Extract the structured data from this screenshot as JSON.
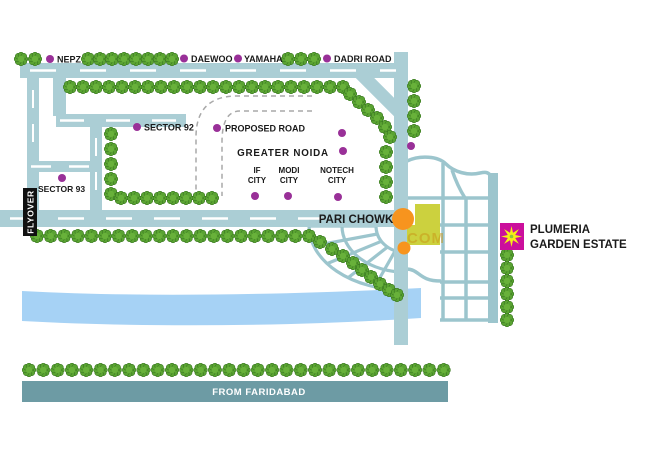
{
  "map": {
    "region_label": "GREATER NOIDA",
    "landmarks": {
      "nepz": "NEPZ",
      "daewoo": "DAEWOO",
      "yamaha": "YAMAHA",
      "dadri_road": "DADRI ROAD",
      "sector_92": "SECTOR 92",
      "proposed_road": "PROPOSED ROAD",
      "if_city": [
        "IF",
        "CITY"
      ],
      "modi_city": [
        "MODI",
        "CITY"
      ],
      "notech_city": [
        "NOTECH",
        "CITY"
      ],
      "sector_93": "SECTOR 93"
    },
    "road_labels": {
      "flyover": "FLYOVER",
      "pari_chowk": "PARI CHOWK",
      "from_faridabad": "FROM FARIDABAD"
    },
    "estate": {
      "line1": "PLUMERIA",
      "line2": "GARDEN ESTATE"
    },
    "watermark": "COM",
    "icons": {
      "tree": "tree-icon",
      "estate_marker": "star-icon",
      "poi_marker": "location-dot"
    },
    "colors": {
      "road": "#abced5",
      "road_dark": "#6d9ba4",
      "grid_road": "#9cc5cd",
      "river": "#a6d2f5",
      "tree_green": "#5aa332",
      "poi_dot": "#993098",
      "estate_magenta": "#cb0f9c",
      "star_yellow": "#f5ee16",
      "junction_orange": "#f7941e",
      "block_yellow": "#ccd13e",
      "flyover_black": "#111111"
    }
  }
}
